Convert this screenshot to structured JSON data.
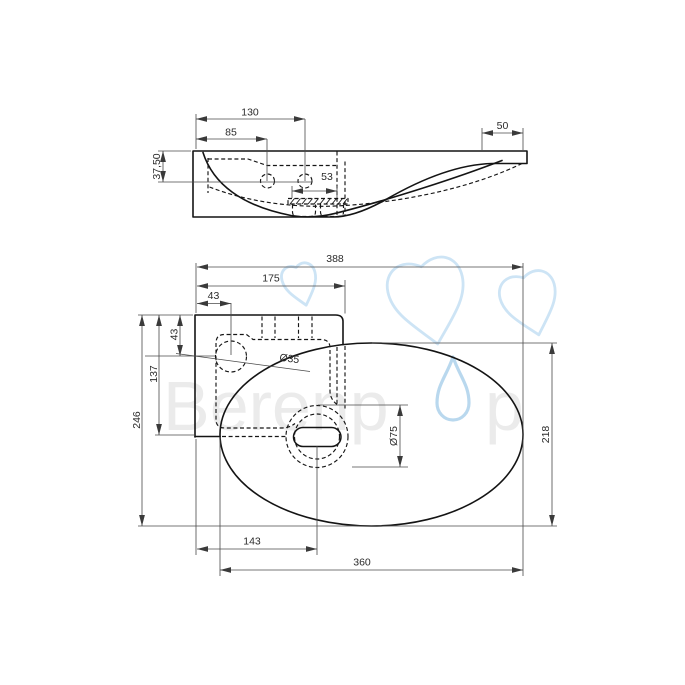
{
  "watermark": {
    "brand_part1": "Berenp",
    "brand_part2": "p"
  },
  "colors": {
    "outline": "#141414",
    "dimension": "#4a4a4a",
    "watermark_text": "#ebebeb",
    "watermark_drop": "#b9d8ee",
    "watermark_cloud": "#cde4f5"
  },
  "side_view": {
    "dim_130": "130",
    "dim_85": "85",
    "dim_50": "50",
    "dim_37_50": "37,50",
    "dim_53": "53"
  },
  "plan_view": {
    "dim_388": "388",
    "dim_175": "175",
    "dim_43_top": "43",
    "dim_43_left": "43",
    "dim_137": "137",
    "dim_246": "246",
    "dim_218": "218",
    "dim_143": "143",
    "dim_360": "360",
    "dia_35": "Ø35",
    "dia_75": "Ø75"
  }
}
